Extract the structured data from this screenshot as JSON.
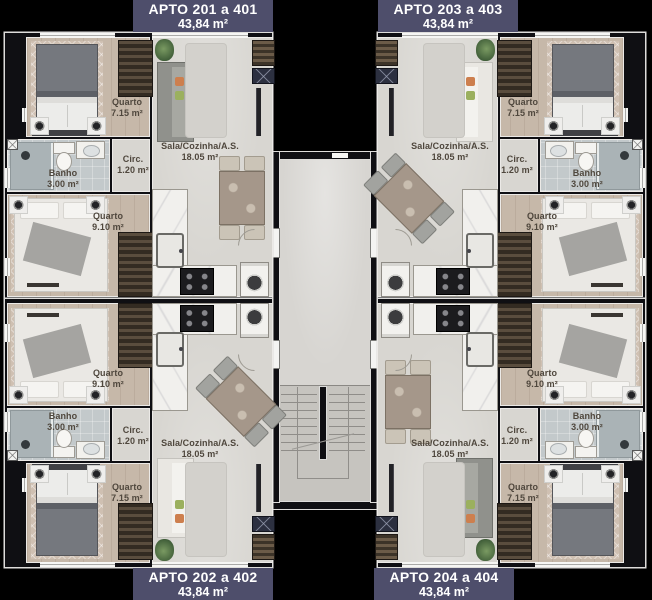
{
  "apartments": [
    {
      "quadrant": "top-left",
      "title": "APTO 201 a 401",
      "area": "43,84 m²"
    },
    {
      "quadrant": "top-right",
      "title": "APTO 203 a 403",
      "area": "43,84 m²"
    },
    {
      "quadrant": "bottom-left",
      "title": "APTO 202 a 402",
      "area": "43,84 m²"
    },
    {
      "quadrant": "bottom-right",
      "title": "APTO 204 a 404",
      "area": "43,84 m²"
    }
  ],
  "rooms": {
    "quarto_small": {
      "label": "Quarto",
      "area": "7.15 m²"
    },
    "quarto_large": {
      "label": "Quarto",
      "area": "9.10 m²"
    },
    "banho": {
      "label": "Banho",
      "area": "3.00 m²"
    },
    "circ": {
      "label": "Circ.",
      "area": "1.20 m²"
    },
    "sala": {
      "label": "Sala/Cozinha/A.S.",
      "area": "18.05 m²"
    }
  },
  "colors": {
    "header_bg": "#4e4e6b",
    "wall": "#0f0f13",
    "wood_floor": "#c6b8a9",
    "living_floor": "#d8d6d1",
    "bath_floor": "#c3c9cb",
    "corridor_floor": "#d7d5d1",
    "stair_floor": "#c6c4bf",
    "label_text": "#4f473d"
  }
}
